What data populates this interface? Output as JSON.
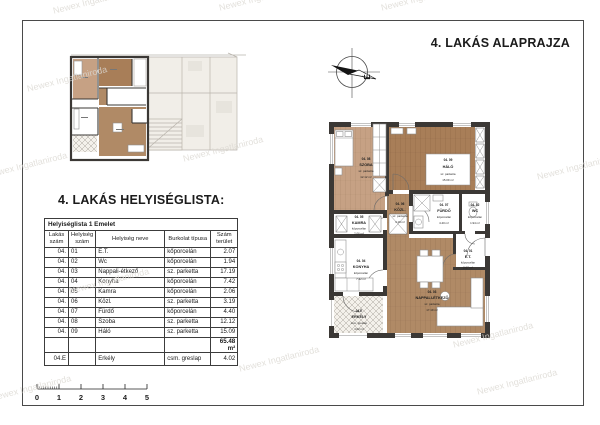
{
  "page": {
    "plan_title": "4. LAKÁS ALAPRAJZA",
    "list_title": "4. LAKÁS HELYISÉGLISTA:",
    "watermark": "Newex Ingatlaniroda",
    "compass_north": "É"
  },
  "table": {
    "caption": "Helyiséglista 1 Emelet",
    "headers": [
      "Lakás szám",
      "Helyiség szám",
      "Helyiség neve",
      "Burkolat típusa",
      "Szám terület"
    ],
    "rows": [
      [
        "04.",
        "01",
        "E.T.",
        "kőporcelán",
        "2.07"
      ],
      [
        "04.",
        "02",
        "Wc",
        "kőporcelán",
        "1.94"
      ],
      [
        "04.",
        "03",
        "Nappali-étkező",
        "sz. parketta",
        "17.19"
      ],
      [
        "04.",
        "04",
        "Konyha",
        "kőporcelán",
        "7.42"
      ],
      [
        "04.",
        "05",
        "Kamra",
        "kőporcelán",
        "2.06"
      ],
      [
        "04.",
        "06",
        "Közl.",
        "sz. parketta",
        "3.19"
      ],
      [
        "04.",
        "07",
        "Fürdő",
        "kőporcelán",
        "4.40"
      ],
      [
        "04.",
        "08",
        "Szoba",
        "sz. parketta",
        "12.12"
      ],
      [
        "04.",
        "09",
        "Háló",
        "sz. parketta",
        "15.09"
      ]
    ],
    "total": "65.48 m²",
    "balcony_row": [
      "04.E",
      "",
      "Erkély",
      "csm. greslap",
      "4.02"
    ]
  },
  "scalebar": {
    "labels": [
      "0",
      "1",
      "2",
      "3",
      "4",
      "5"
    ]
  },
  "floorplan": {
    "rooms": [
      {
        "id": "04. 08",
        "name": "SZOBA",
        "floor": "sz. parketta",
        "area": "12.12 m²"
      },
      {
        "id": "04. 09",
        "name": "HÁLÓ",
        "floor": "sz. parketta",
        "area": "15.09 m²"
      },
      {
        "id": "04. 06",
        "name": "KÖZL.",
        "floor": "sz. parketta",
        "area": "3.19 m²"
      },
      {
        "id": "04. 07",
        "name": "FÜRDŐ",
        "floor": "kőporcelán",
        "area": "4.40 m²"
      },
      {
        "id": "04. 02",
        "name": "WC",
        "floor": "kőporcelán",
        "area": "1.94 m²"
      },
      {
        "id": "04. 05",
        "name": "KAMRA",
        "floor": "kőporcelán",
        "area": "2.06 m²"
      },
      {
        "id": "04. 04",
        "name": "KONYHA",
        "floor": "kőporcelán",
        "area": "7.42 m²"
      },
      {
        "id": "04. 03",
        "name": "NAPPALI-ÉTKEZŐ",
        "floor": "sz. parketta",
        "area": "17.19 m²"
      },
      {
        "id": "04. 01",
        "name": "E.T.",
        "floor": "kőporcelán",
        "area": "2.07 m²"
      },
      {
        "id": "04.E",
        "name": "ERKÉLY",
        "floor": "csm. greslap",
        "area": "4.02 m²"
      }
    ],
    "colors": {
      "wall": "#3b3835",
      "wood_light": "#c6a184",
      "wood_dark": "#a87e58",
      "wood_mid": "#b08a66"
    }
  }
}
